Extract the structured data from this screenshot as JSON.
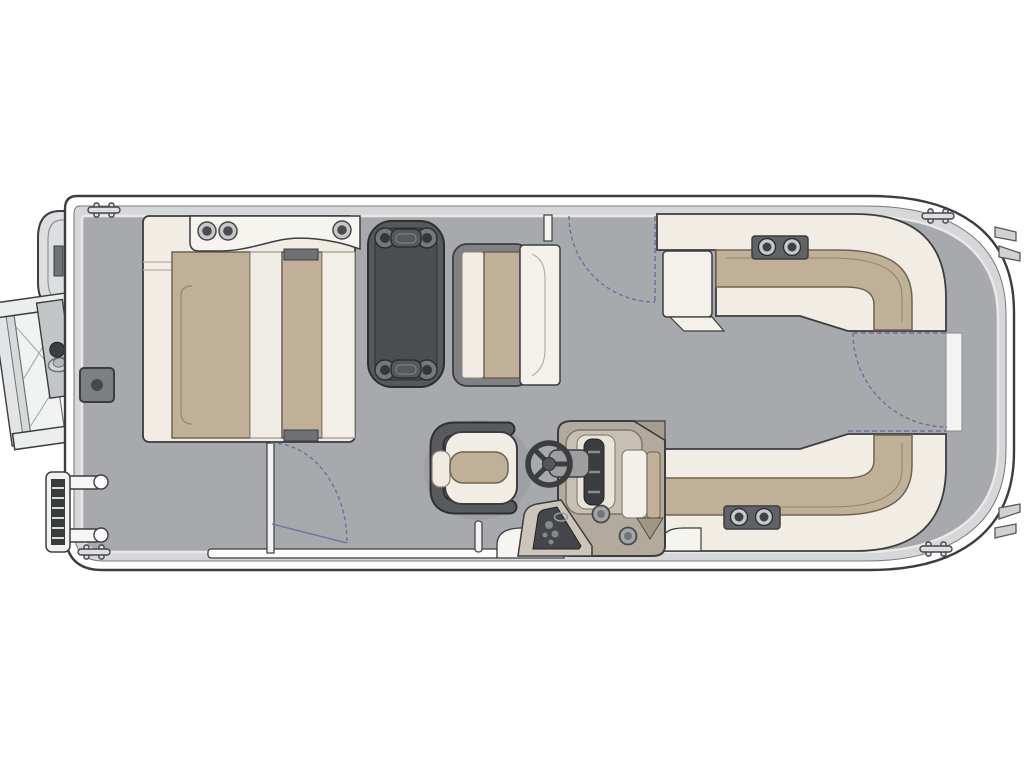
{
  "meta": {
    "label": "Pontoon boat floor plan - top-down deck layout",
    "background": "#ffffff"
  },
  "palette": {
    "line": "#3b3d40",
    "hull_white": "#ffffff",
    "gunwale_band": "#d5d7d9",
    "deck": "#a7a9ac",
    "fence_white": "#f3f3f1",
    "seat_shell_cream": "#f1ede5",
    "seat_trim_white": "#f6f4ee",
    "cushion_tan": "#c0b098",
    "cushion_edge": "#6f6350",
    "table_dark": "#57585a",
    "hardware_gray": "#6e7073",
    "metal_ring": "#c6c8ca",
    "gate_arc_blue": "#6b70a0",
    "console_tan": "#b2aa9d",
    "console_panel_dark": "#45464a",
    "chair_wrap_gray": "#595a5e"
  },
  "items": [
    {
      "name": "hull",
      "label": "pontoon hull outline"
    },
    {
      "name": "deck",
      "label": "gray vinyl deck"
    },
    {
      "name": "boarding-ramp",
      "label": "fold-down boarding ramp (left exterior)"
    },
    {
      "name": "swim-ladder",
      "label": "telescoping boarding ladder (lower left)"
    },
    {
      "name": "left-lounge",
      "label": "L-shaped lounge with chaise, left side"
    },
    {
      "name": "armrest-cupholders",
      "label": "armrest with cup holders"
    },
    {
      "name": "pedestal-table",
      "label": "dark pedestal table with 4 cup holders"
    },
    {
      "name": "dinette-bench",
      "label": "bench seat facing table"
    },
    {
      "name": "top-right-lounge",
      "label": "wraparound corner lounge, top right"
    },
    {
      "name": "bottom-right-lounge",
      "label": "wraparound corner lounge, bottom right"
    },
    {
      "name": "helm-console",
      "label": "helm console with gauges and switch panel"
    },
    {
      "name": "steering-wheel",
      "label": "three-spoke steering wheel"
    },
    {
      "name": "captains-chair",
      "label": "captain's chair with wrap back"
    },
    {
      "name": "gate-swings",
      "label": "entry gate swing arcs (blue dashed)"
    },
    {
      "name": "deck-hatch",
      "label": "square deck hatch"
    },
    {
      "name": "cleats",
      "label": "mooring cleats"
    },
    {
      "name": "hull-fins",
      "label": "stern brackets, right edge"
    }
  ]
}
